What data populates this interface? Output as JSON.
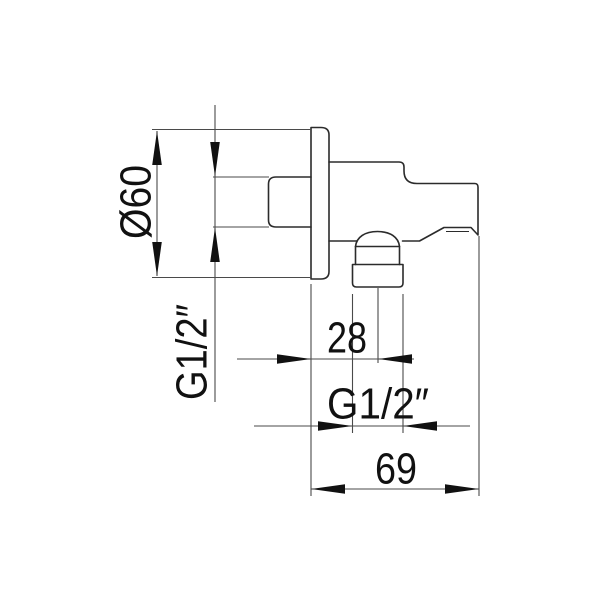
{
  "drawing": {
    "type": "technical-dimension-drawing",
    "subject": "wall shower outlet elbow with hand-shower holder, side view",
    "dimensions": {
      "flange_diameter": {
        "label": "Ø60",
        "value": 60,
        "unit": "mm",
        "orientation": "rotated-vertical"
      },
      "inlet_thread": {
        "label": "G1/2″",
        "orientation": "rotated-vertical"
      },
      "outlet_offset": {
        "label": "28",
        "value": 28,
        "unit": "mm",
        "orientation": "horizontal"
      },
      "outlet_thread": {
        "label": "G1/2″",
        "orientation": "horizontal"
      },
      "body_depth": {
        "label": "69",
        "value": 69,
        "unit": "mm",
        "orientation": "horizontal"
      }
    },
    "colors": {
      "background": "#ffffff",
      "outline": "#2b2b2b",
      "dimension_lines": "#4a4a4a",
      "text": "#111111"
    }
  }
}
